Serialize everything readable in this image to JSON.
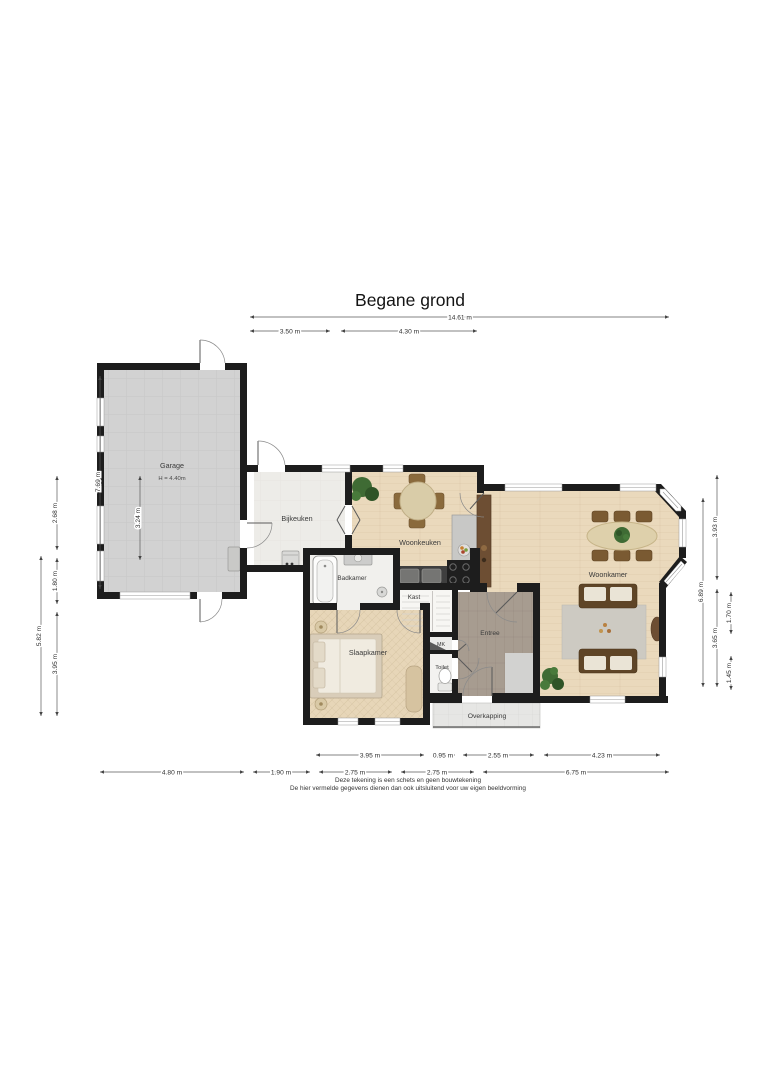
{
  "title": "Begane grond",
  "rooms": {
    "garage": {
      "label": "Garage",
      "height_note": "H = 4.40m"
    },
    "bijkeuken": {
      "label": "Bijkeuken"
    },
    "woonkeuken": {
      "label": "Woonkeuken"
    },
    "woonkamer": {
      "label": "Woonkamer"
    },
    "badkamer": {
      "label": "Badkamer"
    },
    "kast": {
      "label": "Kast"
    },
    "slaapkamer": {
      "label": "Slaapkamer"
    },
    "mk": {
      "label": "MK"
    },
    "toilet": {
      "label": "Toilet"
    },
    "entree": {
      "label": "Entree"
    },
    "overkapping": {
      "label": "Overkapping"
    }
  },
  "dimensions": {
    "top": [
      "14.61 m",
      "3.50 m",
      "4.30 m"
    ],
    "left": [
      "7.69 m",
      "3.24 m",
      "2.68 m",
      "1.80 m",
      "3.95 m",
      "5.82 m"
    ],
    "right": [
      "6.89 m",
      "3.93 m",
      "3.65 m",
      "1.70 m",
      "1.45 m"
    ],
    "bottom_upper": [
      "3.95 m",
      "0.95 m",
      "2.55 m",
      "4.23 m"
    ],
    "bottom_lower": [
      "4.80 m",
      "1.90 m",
      "2.75 m",
      "2.75 m",
      "6.75 m"
    ]
  },
  "disclaimer": {
    "line1": "Deze tekening is een schets en geen bouwtekening",
    "line2": "De hier vermelde gegevens dienen dan ook uitsluitend voor uw eigen beeldvorming"
  },
  "colors": {
    "wall": "#1d1d1d",
    "wood_floor": "#ead9bc",
    "garage_floor": "#d2d2d2",
    "bijkeuken_floor": "#edece8",
    "entree_floor": "#a79c90",
    "overkapping_floor": "#e6e6e4",
    "rug": "#cdcac2",
    "sofa_brown": "#5f4527",
    "cabinet_brown": "#6d4e33",
    "counter_dark": "#3f3f3f",
    "plant_green": "#3f6b34",
    "dimension_text": "#2e2e2e"
  }
}
